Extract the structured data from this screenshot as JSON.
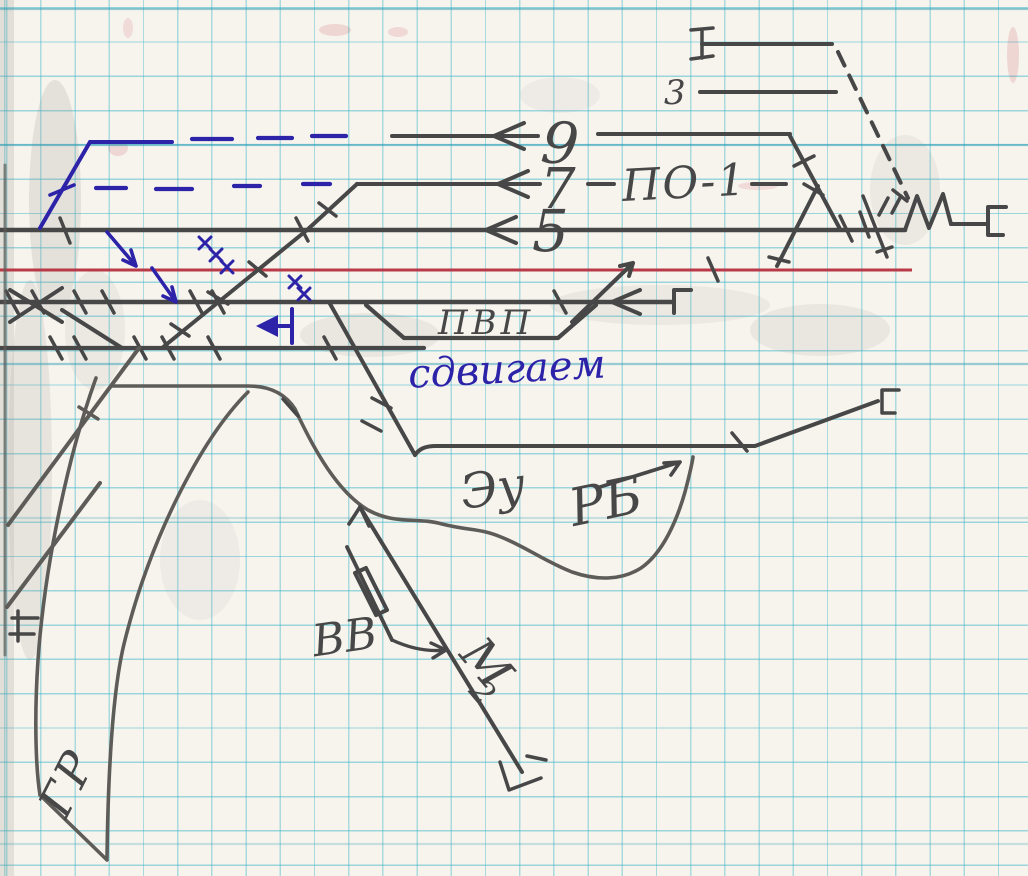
{
  "page": {
    "kind": "hand-drawn railway track scheme on squared notebook paper",
    "language": "ru"
  },
  "labels": {
    "track3": "3",
    "track9": "9",
    "track7": "7",
    "track5": "5",
    "po1": "ПО-1",
    "pvp": "ПВП",
    "sdvigaem": "сдвигаем",
    "eu": "Эу",
    "rb": "РБ",
    "vv": "ВВ",
    "m2": "М",
    "m2_sub": "2",
    "gr": "ГР"
  },
  "colors": {
    "pencil": "#474747",
    "pencil_light": "#5e5c58",
    "ink_blue": "#2d23a8",
    "line_red": "#b93a46",
    "grid": "#58b7c9",
    "paper": "#f7f4ee"
  }
}
